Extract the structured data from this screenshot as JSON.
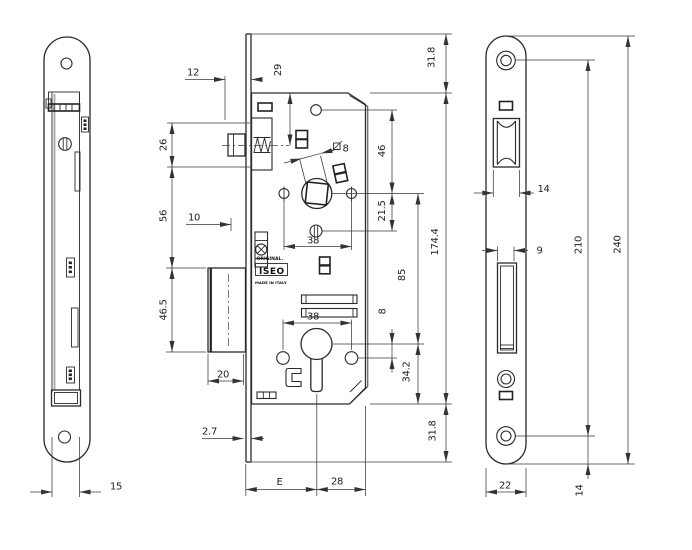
{
  "title": "Mortise lock technical drawing",
  "branding": {
    "original": "ORIGINAL.",
    "logo": "ISEO",
    "made_in": "MADE IN ITALY"
  },
  "dims": {
    "left": {
      "case_depth": "15"
    },
    "body": {
      "latch_front": "12",
      "latch_height": "26",
      "latch_to_bolt": "56",
      "aux_throw": "10",
      "bolt_height": "46.5",
      "bolt_throw": "20",
      "plate_thickness": "2.7",
      "latch_axis": "29",
      "top_margin": "31.8",
      "hole_to_follower": "46",
      "follower_to_screw": "21.5",
      "case_height": "174.4",
      "follower_to_cyl": "85",
      "cyl_to_screw": "8",
      "cyl_to_bottom": "34.2",
      "bottom_margin": "31.8",
      "follower_screws": "38",
      "cyl_screws": "38",
      "follower_square": "8",
      "backset": "E",
      "case_back": "28"
    },
    "right": {
      "roller_width": "14",
      "bolt_slot_width": "9",
      "screw_centers": "210",
      "plate_height": "240",
      "plate_width": "22",
      "screw_to_end": "14"
    }
  }
}
